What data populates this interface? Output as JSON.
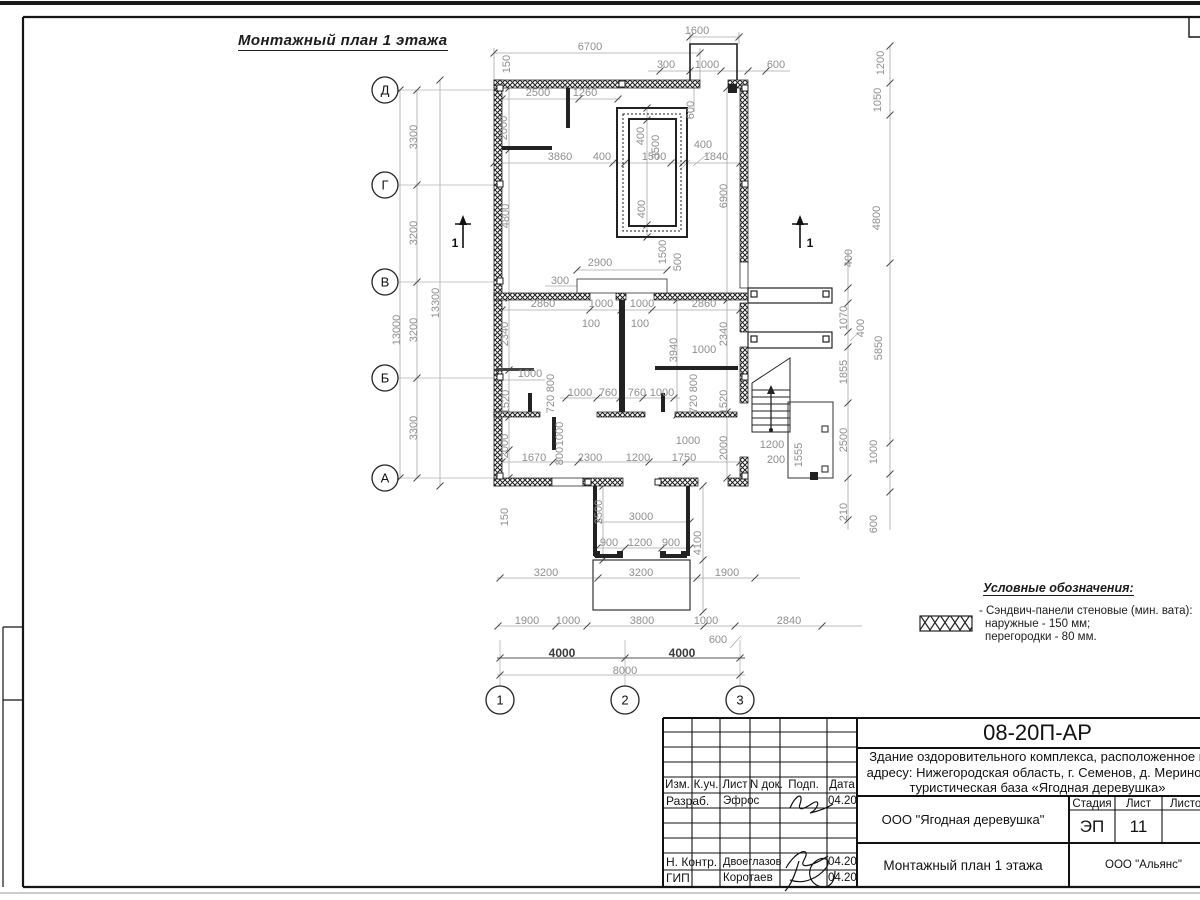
{
  "page": {
    "plan_title": "Монтажный план 1 этажа"
  },
  "plan": {
    "section_label": "1",
    "axes_left": [
      [
        "Д",
        90
      ],
      [
        "Г",
        185
      ],
      [
        "В",
        282
      ],
      [
        "Б",
        378
      ],
      [
        "А",
        478
      ]
    ],
    "axes_bottom": [
      [
        "1",
        500
      ],
      [
        "2",
        625
      ],
      [
        "3",
        740
      ]
    ],
    "dims": [
      [
        "1600",
        697,
        34
      ],
      [
        "6700",
        590,
        50
      ],
      [
        "300",
        666,
        68
      ],
      [
        "1000",
        707,
        68
      ],
      [
        "600",
        776,
        68
      ],
      [
        "150",
        510,
        64,
        "r"
      ],
      [
        "2500",
        538,
        96
      ],
      [
        "1260",
        585,
        96
      ],
      [
        "600",
        694,
        110,
        "r"
      ],
      [
        "2000",
        507,
        128,
        "r"
      ],
      [
        "400",
        644,
        136,
        "r"
      ],
      [
        "3500",
        659,
        147,
        "r"
      ],
      [
        "400",
        703,
        148
      ],
      [
        "3860",
        560,
        160
      ],
      [
        "400",
        602,
        160
      ],
      [
        "1500",
        654,
        160
      ],
      [
        "1840",
        716,
        160
      ],
      [
        "1200",
        884,
        63,
        "r"
      ],
      [
        "1050",
        881,
        100,
        "r"
      ],
      [
        "4800",
        880,
        218,
        "r"
      ],
      [
        "4800",
        509,
        216,
        "r"
      ],
      [
        "6900",
        727,
        196,
        "r"
      ],
      [
        "400",
        852,
        258,
        "r"
      ],
      [
        "400",
        645,
        209,
        "r"
      ],
      [
        "2900",
        600,
        266
      ],
      [
        "1500",
        666,
        252,
        "r"
      ],
      [
        "500",
        681,
        262,
        "r"
      ],
      [
        "300",
        560,
        284
      ],
      [
        "13300",
        439,
        303,
        "r"
      ],
      [
        "13000",
        400,
        330,
        "r"
      ],
      [
        "3300",
        417,
        137,
        "r"
      ],
      [
        "3200",
        417,
        233,
        "r"
      ],
      [
        "3200",
        417,
        330,
        "r"
      ],
      [
        "3300",
        417,
        428,
        "r"
      ],
      [
        "2860",
        543,
        307
      ],
      [
        "1000",
        601,
        307
      ],
      [
        "1000",
        642,
        307
      ],
      [
        "2860",
        704,
        307
      ],
      [
        "100",
        591,
        327
      ],
      [
        "100",
        640,
        327
      ],
      [
        "2340",
        508,
        334,
        "r"
      ],
      [
        "2340",
        727,
        334,
        "r"
      ],
      [
        "3940",
        677,
        350,
        "r"
      ],
      [
        "1000",
        704,
        353
      ],
      [
        "1070",
        847,
        318,
        "r"
      ],
      [
        "400",
        864,
        328,
        "r"
      ],
      [
        "5850",
        882,
        348,
        "r"
      ],
      [
        "1855",
        847,
        372,
        "r"
      ],
      [
        "1000",
        530,
        377
      ],
      [
        "800",
        554,
        383,
        "r"
      ],
      [
        "720",
        554,
        404,
        "r"
      ],
      [
        "800",
        697,
        383,
        "r"
      ],
      [
        "720",
        697,
        404,
        "r"
      ],
      [
        "1520",
        509,
        402,
        "r"
      ],
      [
        "1520",
        727,
        402,
        "r"
      ],
      [
        "1000",
        580,
        396
      ],
      [
        "760",
        608,
        396
      ],
      [
        "760",
        637,
        396
      ],
      [
        "1000",
        662,
        396
      ],
      [
        "1000",
        563,
        434,
        "r"
      ],
      [
        "800",
        563,
        456,
        "r"
      ],
      [
        "2000",
        508,
        446,
        "r"
      ],
      [
        "2000",
        727,
        448,
        "r"
      ],
      [
        "1000",
        688,
        444
      ],
      [
        "1670",
        534,
        461
      ],
      [
        "2300",
        590,
        461
      ],
      [
        "1200",
        638,
        461
      ],
      [
        "1750",
        684,
        461
      ],
      [
        "1200",
        772,
        448
      ],
      [
        "200",
        776,
        463
      ],
      [
        "1555",
        802,
        455,
        "r"
      ],
      [
        "2500",
        847,
        440,
        "r"
      ],
      [
        "1000",
        877,
        452,
        "r"
      ],
      [
        "210",
        847,
        512,
        "r"
      ],
      [
        "600",
        877,
        524,
        "r"
      ],
      [
        "150",
        508,
        517,
        "r"
      ],
      [
        "2500",
        602,
        512,
        "r"
      ],
      [
        "3000",
        641,
        520
      ],
      [
        "4100",
        701,
        543,
        "r"
      ],
      [
        "900",
        609,
        546
      ],
      [
        "1200",
        640,
        546
      ],
      [
        "900",
        671,
        546
      ],
      [
        "3200",
        546,
        576
      ],
      [
        "3200",
        641,
        576
      ],
      [
        "1900",
        727,
        576
      ],
      [
        "1900",
        527,
        624
      ],
      [
        "1000",
        568,
        624
      ],
      [
        "3800",
        642,
        624
      ],
      [
        "1000",
        706,
        624
      ],
      [
        "2840",
        789,
        624
      ],
      [
        "600",
        718,
        643
      ],
      [
        "4000",
        562,
        657,
        "b"
      ],
      [
        "4000",
        682,
        657,
        "b"
      ],
      [
        "8000",
        625,
        674
      ]
    ]
  },
  "legend": {
    "title": "Условные обозначения:",
    "item_lines": [
      "- Сэндвич-панели стеновые (мин. вата):",
      "наружные - 150 мм;",
      "перегородки - 80 мм."
    ]
  },
  "titleblock": {
    "doc_number": "08-20П-АР",
    "description_lines": [
      "Здание оздоровительного комплекса, расположенное п",
      "адресу: Нижегородская область, г. Семенов, д. Меринов",
      "туристическая база «Ягодная деревушка»"
    ],
    "header_cells": [
      "Изм.",
      "К.уч.",
      "Лист",
      "N док.",
      "Подп.",
      "Дата"
    ],
    "rows": {
      "razrab": {
        "role": "Разраб.",
        "name": "Эфрос",
        "date": "04.20"
      },
      "nkontr": {
        "role": "Н. Контр.",
        "name": "Двоеглазов",
        "date": "04.20"
      },
      "gip": {
        "role": "ГИП",
        "name": "Коротаев",
        "date": "04.20"
      }
    },
    "org1": "ООО \"Ягодная деревушка\"",
    "stage_headers": [
      "Стадия",
      "Лист",
      "Листов"
    ],
    "stage_value": "ЭП",
    "sheet_value": "11",
    "drawing_label": "Монтажный план 1 этажа",
    "org2": "ООО \"Альянс\""
  },
  "colors": {
    "dim": "#8f8f8f",
    "wall": "#1a1a1a",
    "accent_bold_dim": "#3a3a3a"
  }
}
